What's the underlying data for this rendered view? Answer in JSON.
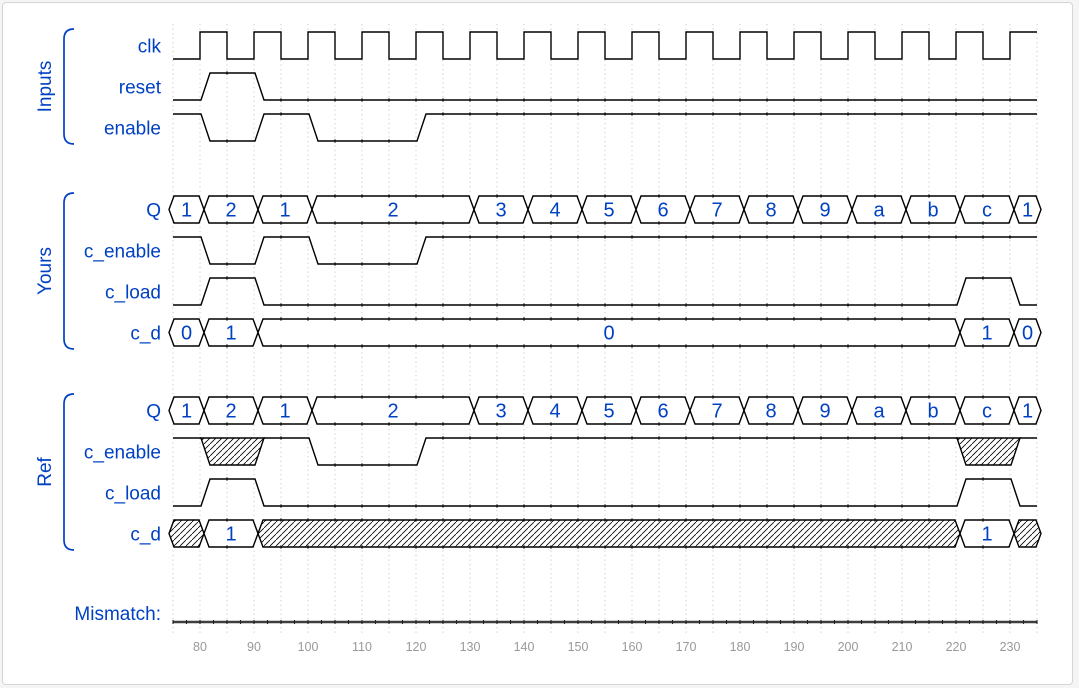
{
  "chart_data": {
    "type": "waveform-timing-diagram",
    "time": {
      "start": 75,
      "end": 235,
      "cycle": 10
    },
    "axis": {
      "tick_step": 10,
      "tick_labels": [
        "80",
        "90",
        "100",
        "110",
        "120",
        "130",
        "140",
        "150",
        "160",
        "170",
        "180",
        "190",
        "200",
        "210",
        "220",
        "230"
      ]
    },
    "groups": [
      {
        "label": "Inputs",
        "signals": [
          {
            "name": "clk",
            "kind": "clock",
            "first_rise": 80,
            "half_period": 5,
            "start_level": 0
          },
          {
            "name": "reset",
            "kind": "bit",
            "segments": [
              [
                75,
                80,
                0
              ],
              [
                80,
                90,
                1
              ],
              [
                90,
                235,
                0
              ]
            ]
          },
          {
            "name": "enable",
            "kind": "bit",
            "segments": [
              [
                75,
                80,
                1
              ],
              [
                80,
                90,
                0
              ],
              [
                90,
                100,
                1
              ],
              [
                100,
                120,
                0
              ],
              [
                120,
                235,
                1
              ]
            ]
          }
        ]
      },
      {
        "label": "Yours",
        "signals": [
          {
            "name": "Q",
            "kind": "bus",
            "segments": [
              [
                75,
                80,
                "1"
              ],
              [
                80,
                90,
                "2"
              ],
              [
                90,
                100,
                "1"
              ],
              [
                100,
                130,
                "2"
              ],
              [
                130,
                140,
                "3"
              ],
              [
                140,
                150,
                "4"
              ],
              [
                150,
                160,
                "5"
              ],
              [
                160,
                170,
                "6"
              ],
              [
                170,
                180,
                "7"
              ],
              [
                180,
                190,
                "8"
              ],
              [
                190,
                200,
                "9"
              ],
              [
                200,
                210,
                "a"
              ],
              [
                210,
                220,
                "b"
              ],
              [
                220,
                230,
                "c"
              ],
              [
                230,
                235,
                "1"
              ]
            ]
          },
          {
            "name": "c_enable",
            "kind": "bit",
            "segments": [
              [
                75,
                80,
                1
              ],
              [
                80,
                90,
                0
              ],
              [
                90,
                100,
                1
              ],
              [
                100,
                120,
                0
              ],
              [
                120,
                235,
                1
              ]
            ]
          },
          {
            "name": "c_load",
            "kind": "bit",
            "segments": [
              [
                75,
                80,
                0
              ],
              [
                80,
                90,
                1
              ],
              [
                90,
                220,
                0
              ],
              [
                220,
                230,
                1
              ],
              [
                230,
                235,
                0
              ]
            ]
          },
          {
            "name": "c_d",
            "kind": "bus",
            "segments": [
              [
                75,
                80,
                "0"
              ],
              [
                80,
                90,
                "1"
              ],
              [
                90,
                220,
                "0"
              ],
              [
                220,
                230,
                "1"
              ],
              [
                230,
                235,
                "0"
              ]
            ]
          }
        ]
      },
      {
        "label": "Ref",
        "signals": [
          {
            "name": "Q",
            "kind": "bus",
            "segments": [
              [
                75,
                80,
                "1"
              ],
              [
                80,
                90,
                "2"
              ],
              [
                90,
                100,
                "1"
              ],
              [
                100,
                130,
                "2"
              ],
              [
                130,
                140,
                "3"
              ],
              [
                140,
                150,
                "4"
              ],
              [
                150,
                160,
                "5"
              ],
              [
                160,
                170,
                "6"
              ],
              [
                170,
                180,
                "7"
              ],
              [
                180,
                190,
                "8"
              ],
              [
                190,
                200,
                "9"
              ],
              [
                200,
                210,
                "a"
              ],
              [
                210,
                220,
                "b"
              ],
              [
                220,
                230,
                "c"
              ],
              [
                230,
                235,
                "1"
              ]
            ]
          },
          {
            "name": "c_enable",
            "kind": "bit",
            "segments": [
              [
                75,
                80,
                1
              ],
              [
                80,
                90,
                "x"
              ],
              [
                90,
                100,
                1
              ],
              [
                100,
                120,
                0
              ],
              [
                120,
                220,
                1
              ],
              [
                220,
                230,
                "x"
              ],
              [
                230,
                235,
                1
              ]
            ]
          },
          {
            "name": "c_load",
            "kind": "bit",
            "segments": [
              [
                75,
                80,
                0
              ],
              [
                80,
                90,
                1
              ],
              [
                90,
                220,
                0
              ],
              [
                220,
                230,
                1
              ],
              [
                230,
                235,
                0
              ]
            ]
          },
          {
            "name": "c_d",
            "kind": "bus",
            "segments": [
              [
                75,
                80,
                "x"
              ],
              [
                80,
                90,
                "1"
              ],
              [
                90,
                220,
                "x"
              ],
              [
                220,
                230,
                "1"
              ],
              [
                230,
                235,
                "x"
              ]
            ]
          }
        ]
      },
      {
        "label": null,
        "mismatch_row": true,
        "row_label": "Mismatch:",
        "signals": [
          {
            "name": "Mismatch:",
            "kind": "flat",
            "value": 0
          }
        ]
      }
    ],
    "colors": {
      "label_blue": "#0041c4",
      "wave_line": "#000000",
      "bus_fill": "#ffffff",
      "grid": "#c9c9c9",
      "axis_text": "#999999",
      "mismatch_line": "#3d3d3d",
      "frame_border": "#d5d5d5"
    }
  }
}
